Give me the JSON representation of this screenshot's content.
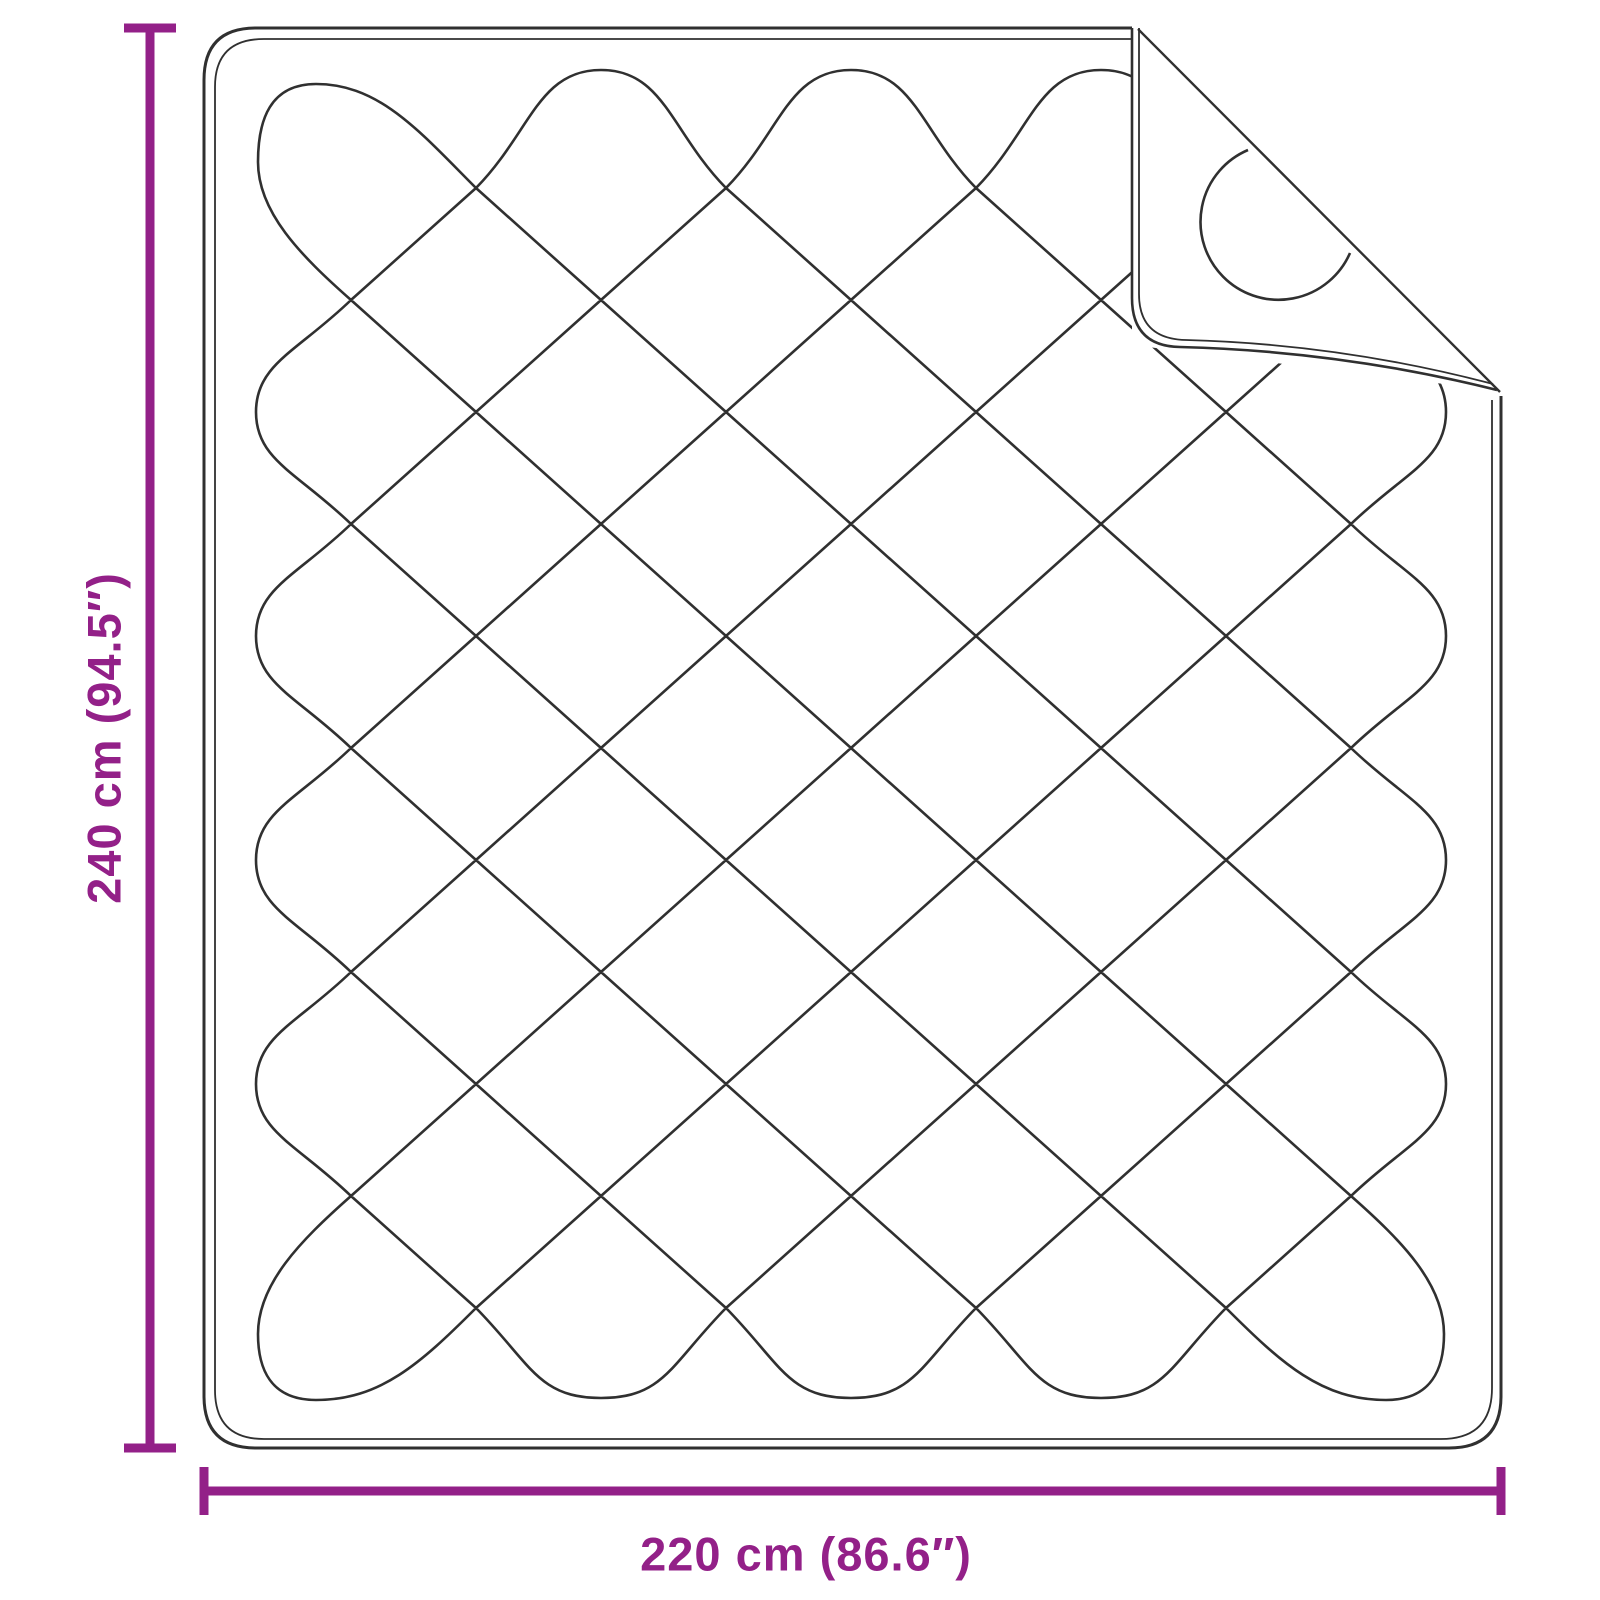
{
  "diagram": {
    "subject": "quilted-blanket-with-folded-corner",
    "height_label": "240 cm (94.5″)",
    "width_label": "220 cm (86.6″)",
    "colors": {
      "dimension": "#932088",
      "outline": "#303030",
      "background": "#ffffff"
    }
  }
}
